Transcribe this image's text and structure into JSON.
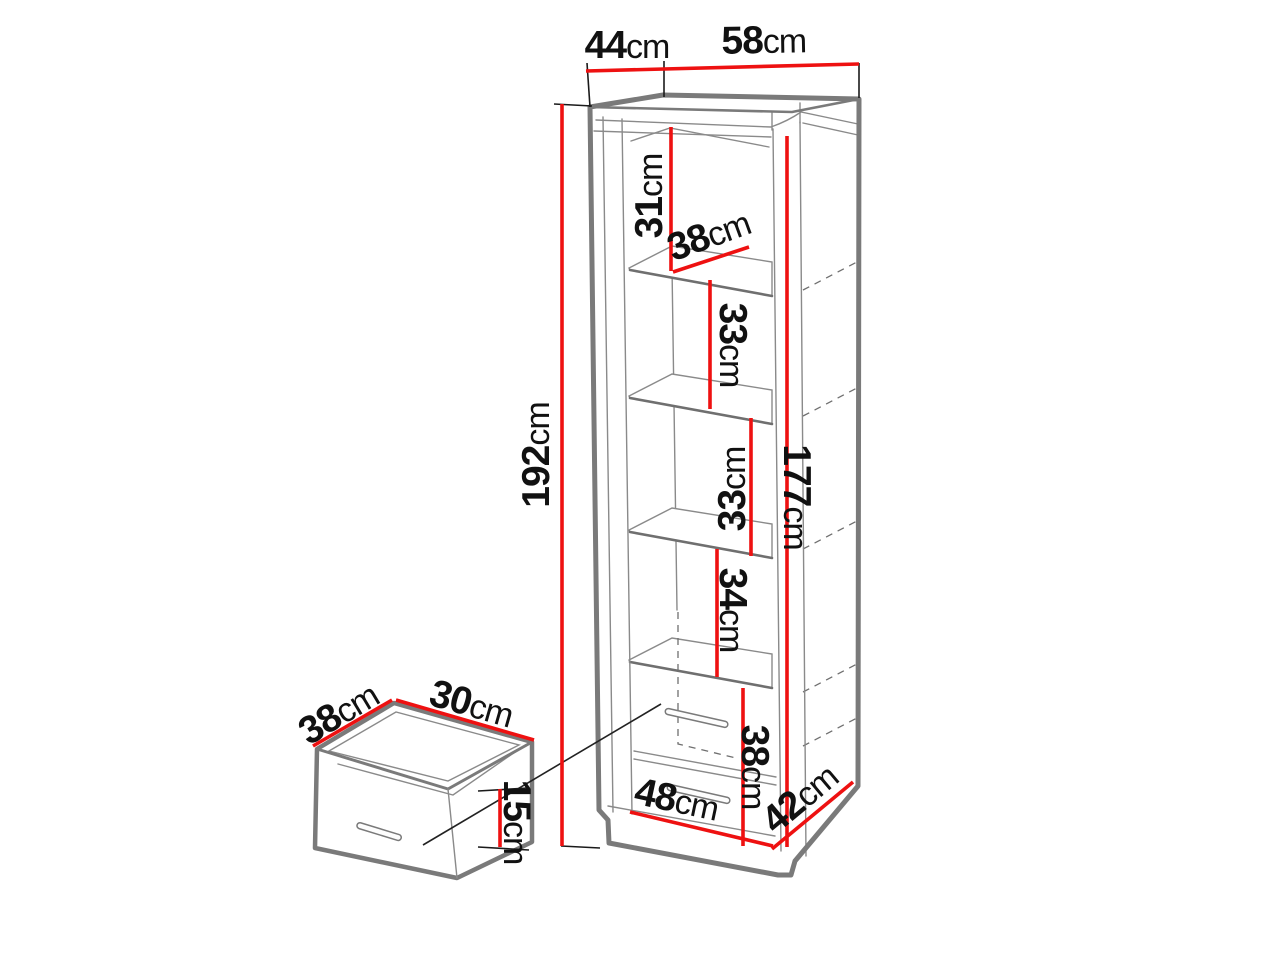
{
  "title": "Tall bookcase with internal drawer — dimension diagram",
  "unit": "cm",
  "colors": {
    "dimension_line": "#ee1111",
    "outline": "#7a7a7a",
    "text": "#111111",
    "background": "#ffffff"
  },
  "cabinet": {
    "name": "tall-bookcase",
    "dimensions": {
      "top_depth": {
        "value": "44",
        "unit": "cm"
      },
      "top_width": {
        "value": "58",
        "unit": "cm"
      },
      "height": {
        "value": "192",
        "unit": "cm"
      },
      "top_shelf_space": {
        "value": "31",
        "unit": "cm"
      },
      "shelf_depth": {
        "value": "38",
        "unit": "cm"
      },
      "shelf_space_2": {
        "value": "33",
        "unit": "cm"
      },
      "shelf_space_3": {
        "value": "33",
        "unit": "cm"
      },
      "shelf_space_4": {
        "value": "34",
        "unit": "cm"
      },
      "interior_height": {
        "value": "177",
        "unit": "cm"
      },
      "drawer_section_height": {
        "value": "38",
        "unit": "cm"
      },
      "base_width": {
        "value": "48",
        "unit": "cm"
      },
      "base_depth": {
        "value": "42",
        "unit": "cm"
      }
    }
  },
  "drawer_detail": {
    "name": "internal-drawer",
    "dimensions": {
      "depth": {
        "value": "38",
        "unit": "cm"
      },
      "width": {
        "value": "30",
        "unit": "cm"
      },
      "height": {
        "value": "15",
        "unit": "cm"
      }
    }
  }
}
